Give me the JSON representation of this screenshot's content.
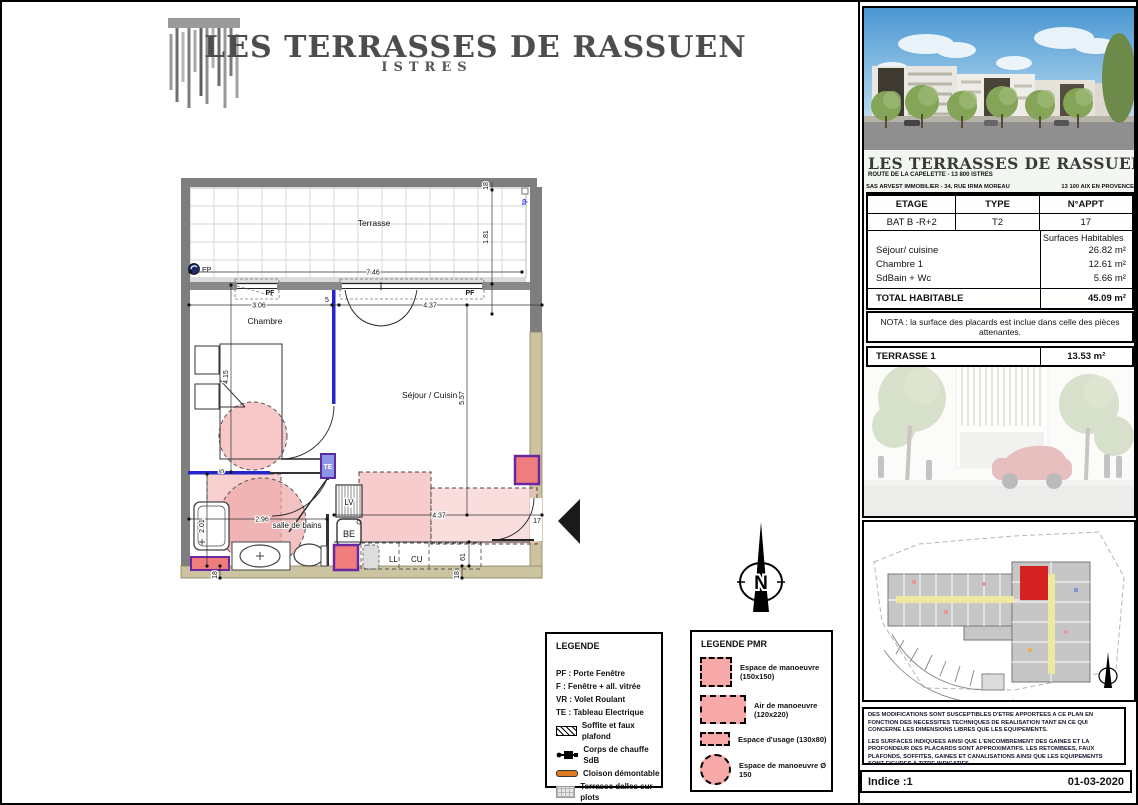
{
  "header": {
    "title": "LES TERRASSES DE RASSUEN",
    "subtitle": "ISTRES"
  },
  "plan": {
    "labels": {
      "terrasse": "Terrasse",
      "chambre": "Chambre",
      "sejour": "Séjour / Cuisine",
      "sdb": "salle de bains",
      "ep": "EP",
      "tp": "tp",
      "te": "TE",
      "lv": "LV",
      "be": "BE",
      "ll": "LL",
      "cu": "CU",
      "pf1": "PF",
      "pf2": "PF",
      "north": "N"
    },
    "dims": {
      "d746": "7.46",
      "d181": "1.81",
      "d18a": "18",
      "d306": "3.06",
      "d5a": "5",
      "d437a": "4.37",
      "d415": "4.15",
      "d557": "5.57",
      "d296": "2.96",
      "d201": "2.01",
      "d5b": "5",
      "d437b": "4.37",
      "d61": "61",
      "d18b": "18",
      "d18c": "18",
      "d17": "17"
    }
  },
  "legend": {
    "title": "LEGENDE",
    "items": [
      "PF : Porte Fenêtre",
      "F : Fenêtre + all. vitrée",
      "VR : Volet Roulant",
      "TE : Tableau Electrique",
      "Soffite et faux plafond",
      "Corps de chauffe SdB",
      "Cloison démontable",
      "Terrasse dalles sur plots"
    ]
  },
  "legend_pmr": {
    "title": "LEGENDE PMR",
    "items": [
      {
        "line1": "Espace de manoeuvre",
        "line2": "(150x150)"
      },
      {
        "line1": "Air de manoeuvre",
        "line2": "(120x220)"
      },
      {
        "line1": "Espace d'usage (130x80)",
        "line2": ""
      },
      {
        "line1": "Espace de manoeuvre Ø 150",
        "line2": ""
      }
    ]
  },
  "panel": {
    "title": "LES TERRASSES DE RASSUEN",
    "address": "ROUTE DE LA CAPELETTE - 13 800 ISTRES",
    "developer": "SAS ARVEST IMMOBILIER - 34, RUE IRMA MOREAU",
    "developer_city": "13 100 AIX EN PROVENCE",
    "table": {
      "headers": [
        "ETAGE",
        "TYPE",
        "N°APPT"
      ],
      "values": [
        "BAT B -R+2",
        "T2",
        "17"
      ]
    },
    "surfaces": {
      "header": "Surfaces Habitables",
      "rows": [
        {
          "label": "Séjour/ cuisine",
          "value": "26.82 m²"
        },
        {
          "label": "Chambre 1",
          "value": "12.61 m²"
        },
        {
          "label": "SdBain + Wc",
          "value": "5.66 m²"
        }
      ]
    },
    "total": {
      "label": "TOTAL HABITABLE",
      "value": "45.09 m²"
    },
    "nota": "NOTA : la surface des placards est inclue dans celle des pièces attenantes.",
    "terrasse_row": {
      "label": "TERRASSE 1",
      "value": "13.53 m²"
    },
    "notes": [
      "DES MODIFICATIONS SONT SUSCEPTIBLES D'ETRE APPORTEES A CE PLAN EN FONCTION DES NECESSITES TECHNIQUES DE REALISATION TANT EN CE QUI CONCERNE LES DIMENSIONS LIBRES QUE LES EQUIPEMENTS.",
      "LES SURFACES INDIQUEES AINSI QUE L'ENCOMBREMENT DES GAINES ET LA PROFONDEUR DES PLACARDS SONT APPROXIMATIFS. LES RETOMBEES, FAUX PLAFONDS, SOFFITES, GAINES ET CANALISATIONS AINSI QUE LES EQUIPEMENTS SONT FIGURES A TITRE INDICATIFS."
    ],
    "indice": {
      "label": "Indice :1",
      "date": "01-03-2020"
    }
  },
  "colors": {
    "pmr_pink": "#f5b5b5",
    "gaine_red": "#ef7d7d",
    "gaine_purple": "#6a28a0",
    "partition_blue": "#2525c8",
    "wall_gray": "#7e7e7e",
    "wall_tan": "#ccc4a0",
    "highlight_red": "#d42222",
    "cloison_orange": "#e07a20"
  }
}
